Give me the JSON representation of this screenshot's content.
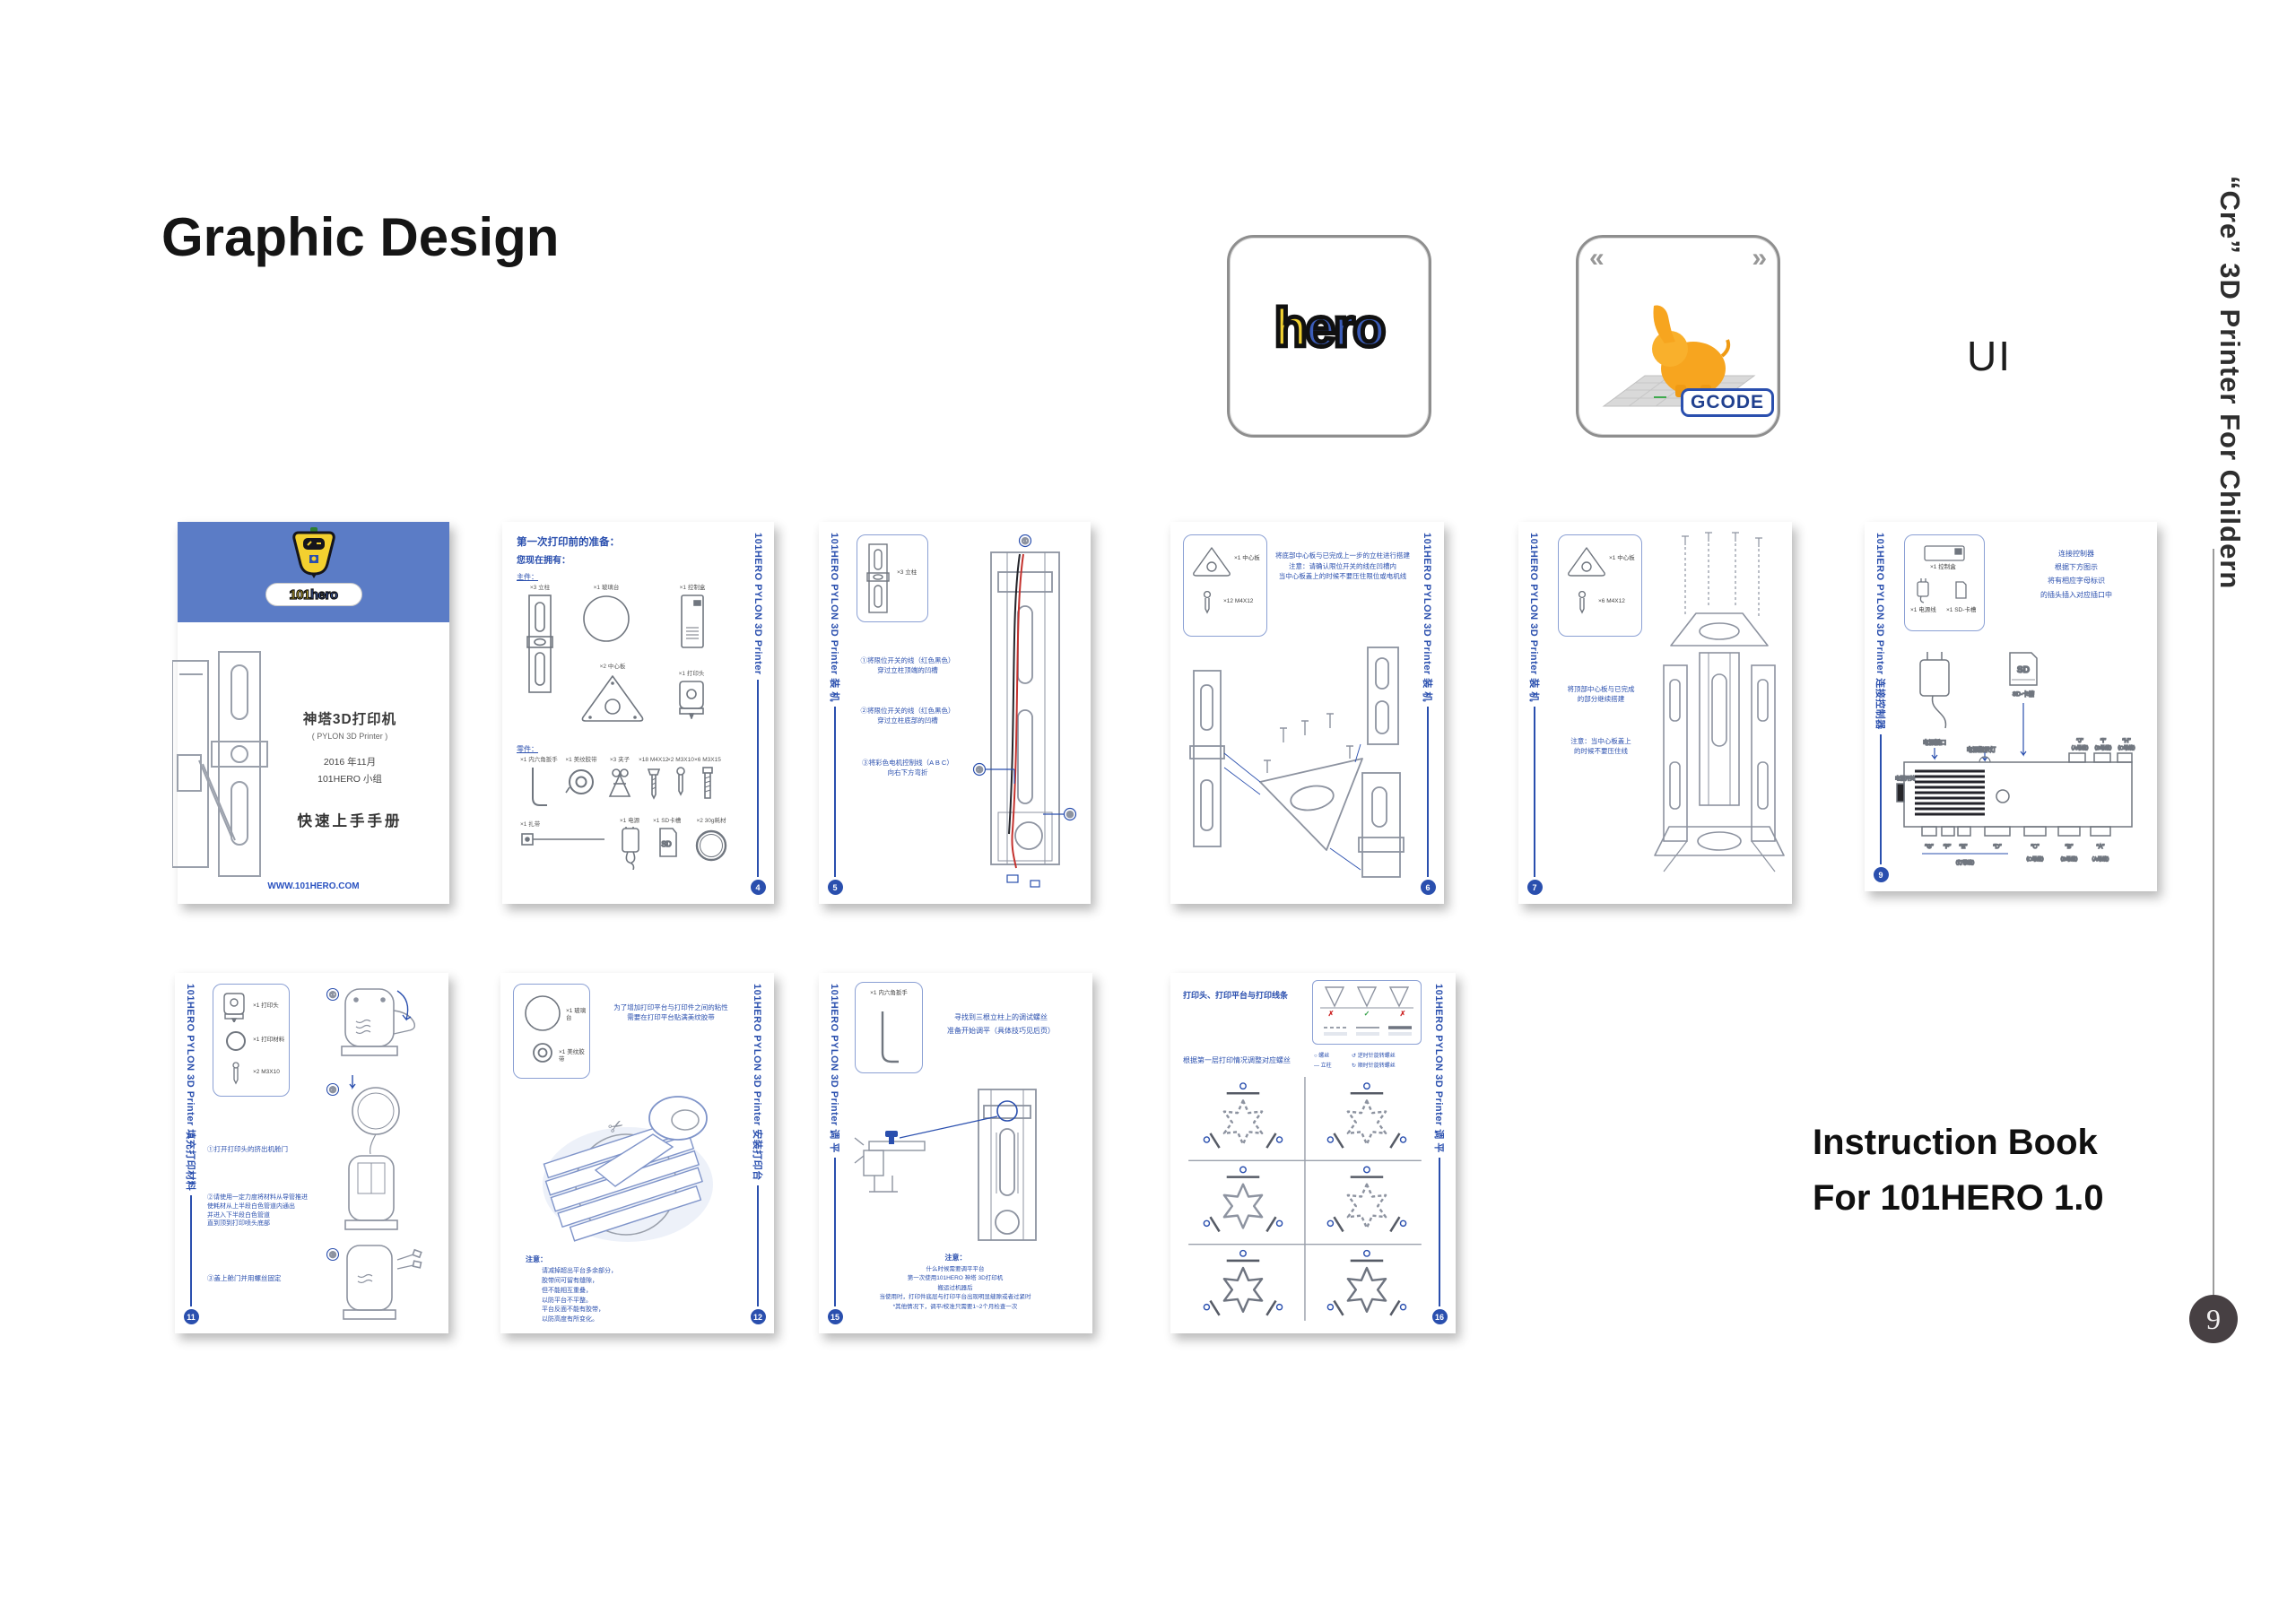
{
  "header": {
    "title": "Graphic Design",
    "ui_label": "UI"
  },
  "right_rail": {
    "vertical_caption": "“Cre” 3D Printer For Childern",
    "page_number": "9"
  },
  "caption": {
    "line1": "Instruction Book",
    "line2": "For 101HERO 1.0"
  },
  "app_icons": {
    "hero": {
      "h": "h",
      "ero": "ero"
    },
    "gcode": {
      "badge": "GCODE",
      "chevron_left": "«",
      "chevron_right": "»"
    }
  },
  "cover": {
    "logo_101": "101",
    "logo_hero": "hero",
    "title_cn": "神塔3D打印机",
    "subtitle_en": "( PYLON 3D Printer )",
    "date": "2016 年11月",
    "team": "101HERO 小组",
    "handbook": "快速上手手册",
    "url": "WWW.101HERO.COM"
  },
  "p4": {
    "sidebar": "101HERO PYLON 3D Printer",
    "num": "4",
    "h1": "第一次打印前的准备：",
    "h2": "您现在拥有：",
    "link_main": "主件：",
    "link_parts": "零件：",
    "main_parts": [
      "×3 立柱",
      "×1 玻璃台",
      "×1 控制盒",
      "×2 中心板",
      "×1 打印头"
    ],
    "small_parts": [
      "×1 内六角扳手",
      "×1 美纹胶带",
      "×3 夹子",
      "×18 M4X12",
      "×2 M3X10",
      "×6 M3X15",
      "×1 扎带",
      "×1 电源",
      "×1 SD卡槽",
      "×2 30g耗材"
    ]
  },
  "p5": {
    "sidebar": "101HERO PYLON 3D Printer 装 机",
    "num": "5",
    "inset_label": "×3 立柱",
    "step1a": "①将限位开关的线（红色黑色）",
    "step1b": "穿过立柱顶端的凹槽",
    "step2a": "②将限位开关的线（红色黑色）",
    "step2b": "穿过立柱底部的凹槽",
    "step3a": "③将彩色电机控制线（A B C）",
    "step3b": "向右下方弯折",
    "callouts": [
      "①",
      "②",
      "③"
    ]
  },
  "p6": {
    "sidebar": "101HERO PYLON 3D Printer 装 机",
    "num": "6",
    "inset_plate": "×1 中心板",
    "inset_screw": "×12 M4X12",
    "note1": "将底部中心板与已完成上一步的立柱进行搭建",
    "note2": "注意：请确认限位开关的线在凹槽内",
    "note3": "当中心板盖上的时候不要压住限位或电机线"
  },
  "p7": {
    "sidebar": "101HERO PYLON 3D Printer 装 机",
    "num": "7",
    "inset_plate": "×1 中心板",
    "inset_screw": "×6 M4X12",
    "note1a": "将顶部中心板与已完成",
    "note1b": "的部分继续搭建",
    "note2a": "注意：当中心板盖上",
    "note2b": "的时候不要压住线"
  },
  "p9": {
    "sidebar": "101HERO PYLON 3D Printer 连接控制器",
    "num": "9",
    "inset_box": "×1 控制盒",
    "inset_power": "×1 电源线",
    "inset_sd": "×1 SD-卡槽",
    "note1": "连接控制器",
    "note2": "根据下方图示",
    "note3": "将有相应字母标识",
    "note4": "的插头插入对应插口中",
    "labels": {
      "power_port": "电源插口",
      "power_led": "电源指示灯",
      "sd_slot": "SD-卡槽",
      "sd": "SD",
      "power_switch": "电源开关",
      "strip": "（灯带线）"
    },
    "top_ports": [
      "“J”",
      "“I”",
      "“H”"
    ],
    "top_notes": [
      "（A母线）",
      "（B母线）",
      "（C母线）"
    ],
    "bottom_ports": [
      "“G”",
      "“F”",
      "“E”",
      "“D”",
      "“C”",
      "“B”",
      "“A”"
    ],
    "bottom_notes": [
      "（C母线）",
      "（B母线）",
      "（A母线）"
    ]
  },
  "p11": {
    "sidebar": "101HERO PYLON 3D Printer 填充打印材料",
    "num": "11",
    "inset_head": "×1 打印头",
    "inset_filament": "×1 打印材料",
    "inset_screw": "×2 M3X10",
    "step1": "①打开打印头的挤出机舱门",
    "step2a": "②请使用一定力度将材料从导管推进",
    "step2b": "使耗材从上半段白色管道内通出",
    "step2c": "并进入下半段白色管道",
    "step2d": "直到顶到打印喷头底部",
    "step3": "③盖上舱门并用螺丝固定",
    "callouts": [
      "①",
      "②",
      "③"
    ]
  },
  "p12": {
    "sidebar": "101HERO PYLON 3D Printer 安装打印台",
    "num": "12",
    "inset_glass": "×1 玻璃台",
    "inset_tape": "×1 美纹胶带",
    "intro1": "为了增加打印平台与打印件之间的粘性",
    "intro2": "需要在打印平台贴满美纹胶带",
    "note_title": "注意：",
    "note1": "请减掉超出平台多余部分，",
    "note2": "胶带间可留有缝隙，",
    "note3": "但不能相互重叠，",
    "note4": "以防平台不平整。",
    "note5": "平台反面不能有胶带，",
    "note6": "以防高度有所变化。"
  },
  "p15": {
    "sidebar": "101HERO PYLON 3D Printer 调 平",
    "num": "15",
    "inset_wrench": "×1 内六角扳手",
    "intro1": "寻找到三根立柱上的调试螺丝",
    "intro2": "准备开始调平（具体技巧见后页）",
    "note_title": "注意：",
    "note1": "什么时候需要调平平台",
    "note2": "第一次使用101HERO 神塔 3D打印机",
    "note3": "搬运过机器后",
    "note4": "当使用时，打印件底层与打印平台出现明显缝隙或者过紧时",
    "note5": "*其他情况下，调平/校准只需要1~2个月检查一次"
  },
  "p16": {
    "sidebar": "101HERO PYLON 3D Printer 调 平",
    "num": "16",
    "title": "打印头、打印平台与打印线条",
    "subtitle": "根据第一层打印情况调整对应螺丝",
    "marks": [
      "✗",
      "✓",
      "✗"
    ],
    "legend": [
      "○ 螺丝",
      "↺ 逆时针旋转螺丝",
      "— 立柱",
      "↻ 顺时针旋转螺丝"
    ]
  }
}
